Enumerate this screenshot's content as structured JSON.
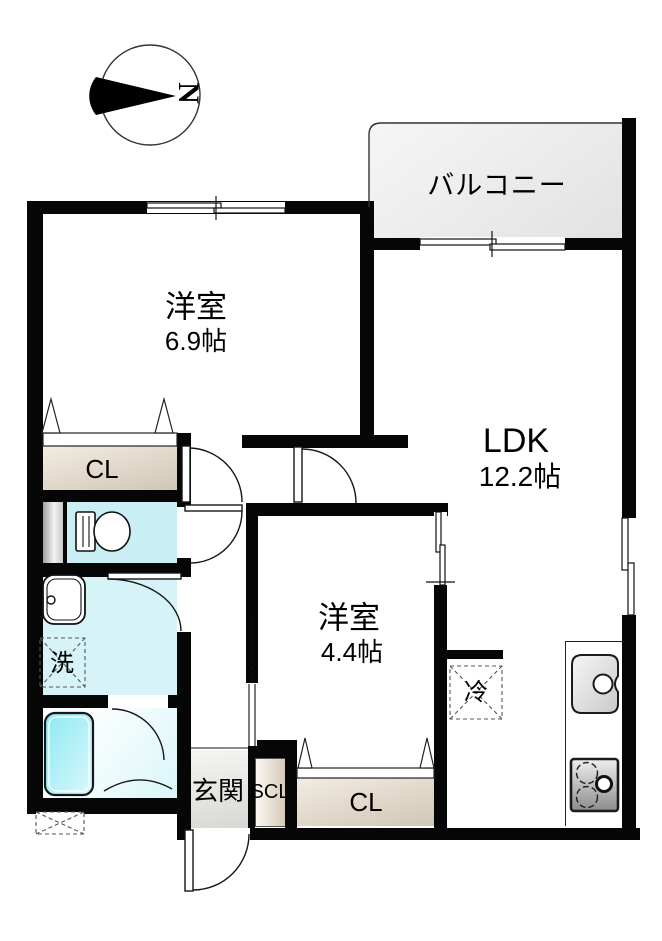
{
  "compass": {
    "label": "N"
  },
  "rooms": {
    "balcony": {
      "label": "バルコニー"
    },
    "western1": {
      "name": "洋室",
      "area": "6.9帖"
    },
    "ldk": {
      "name": "LDK",
      "area": "12.2帖"
    },
    "western2": {
      "name": "洋室",
      "area": "4.4帖"
    },
    "closet1": {
      "label": "CL"
    },
    "closet2": {
      "label": "CL"
    },
    "shoe_closet": {
      "label": "SCL"
    },
    "entrance": {
      "label": "玄関"
    },
    "laundry": {
      "label": "洗"
    },
    "refrigerator": {
      "label": "冷"
    }
  },
  "colors": {
    "wall": "#060606",
    "balcony_floor": "#ebebeb",
    "closet_beige": "#d8ccbc",
    "toilet_cyan": "#c9eff5",
    "wash_cyan": "#d6f4f8",
    "bathtub_cyan": "#8fe9f2",
    "entrance_gray": "#e3e3e0"
  }
}
